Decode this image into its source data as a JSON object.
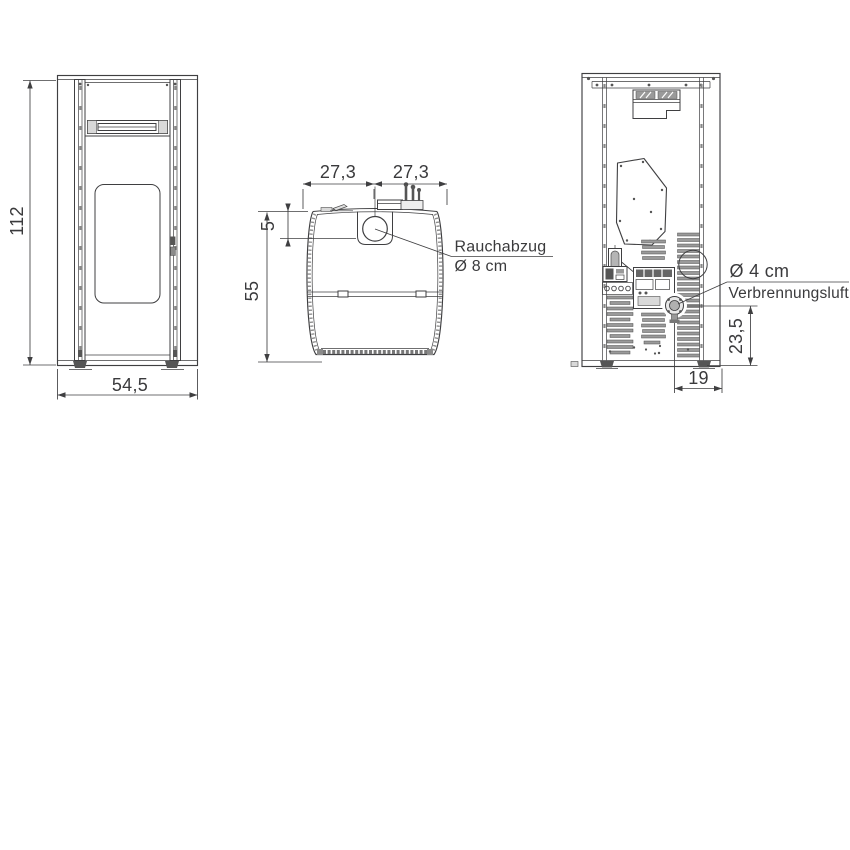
{
  "colors": {
    "background": "#ffffff",
    "line": "#3f3f41",
    "text": "#3a3a3c",
    "slat_fill": "#9a9a9a"
  },
  "views": {
    "front": {
      "height_cm": "112",
      "width_cm": "54,5"
    },
    "top": {
      "back_left_cm": "27,3",
      "back_right_cm": "27,3",
      "flue_offset_cm": "5",
      "depth_cm": "55",
      "flue_label": {
        "title": "Rauchabzug",
        "diameter": "Ø 8 cm"
      }
    },
    "rear": {
      "air_label": {
        "diameter": "Ø 4 cm",
        "title": "Verbrennungsluft"
      },
      "inlet_height_cm": "23,5",
      "inlet_offset_cm": "19"
    }
  }
}
